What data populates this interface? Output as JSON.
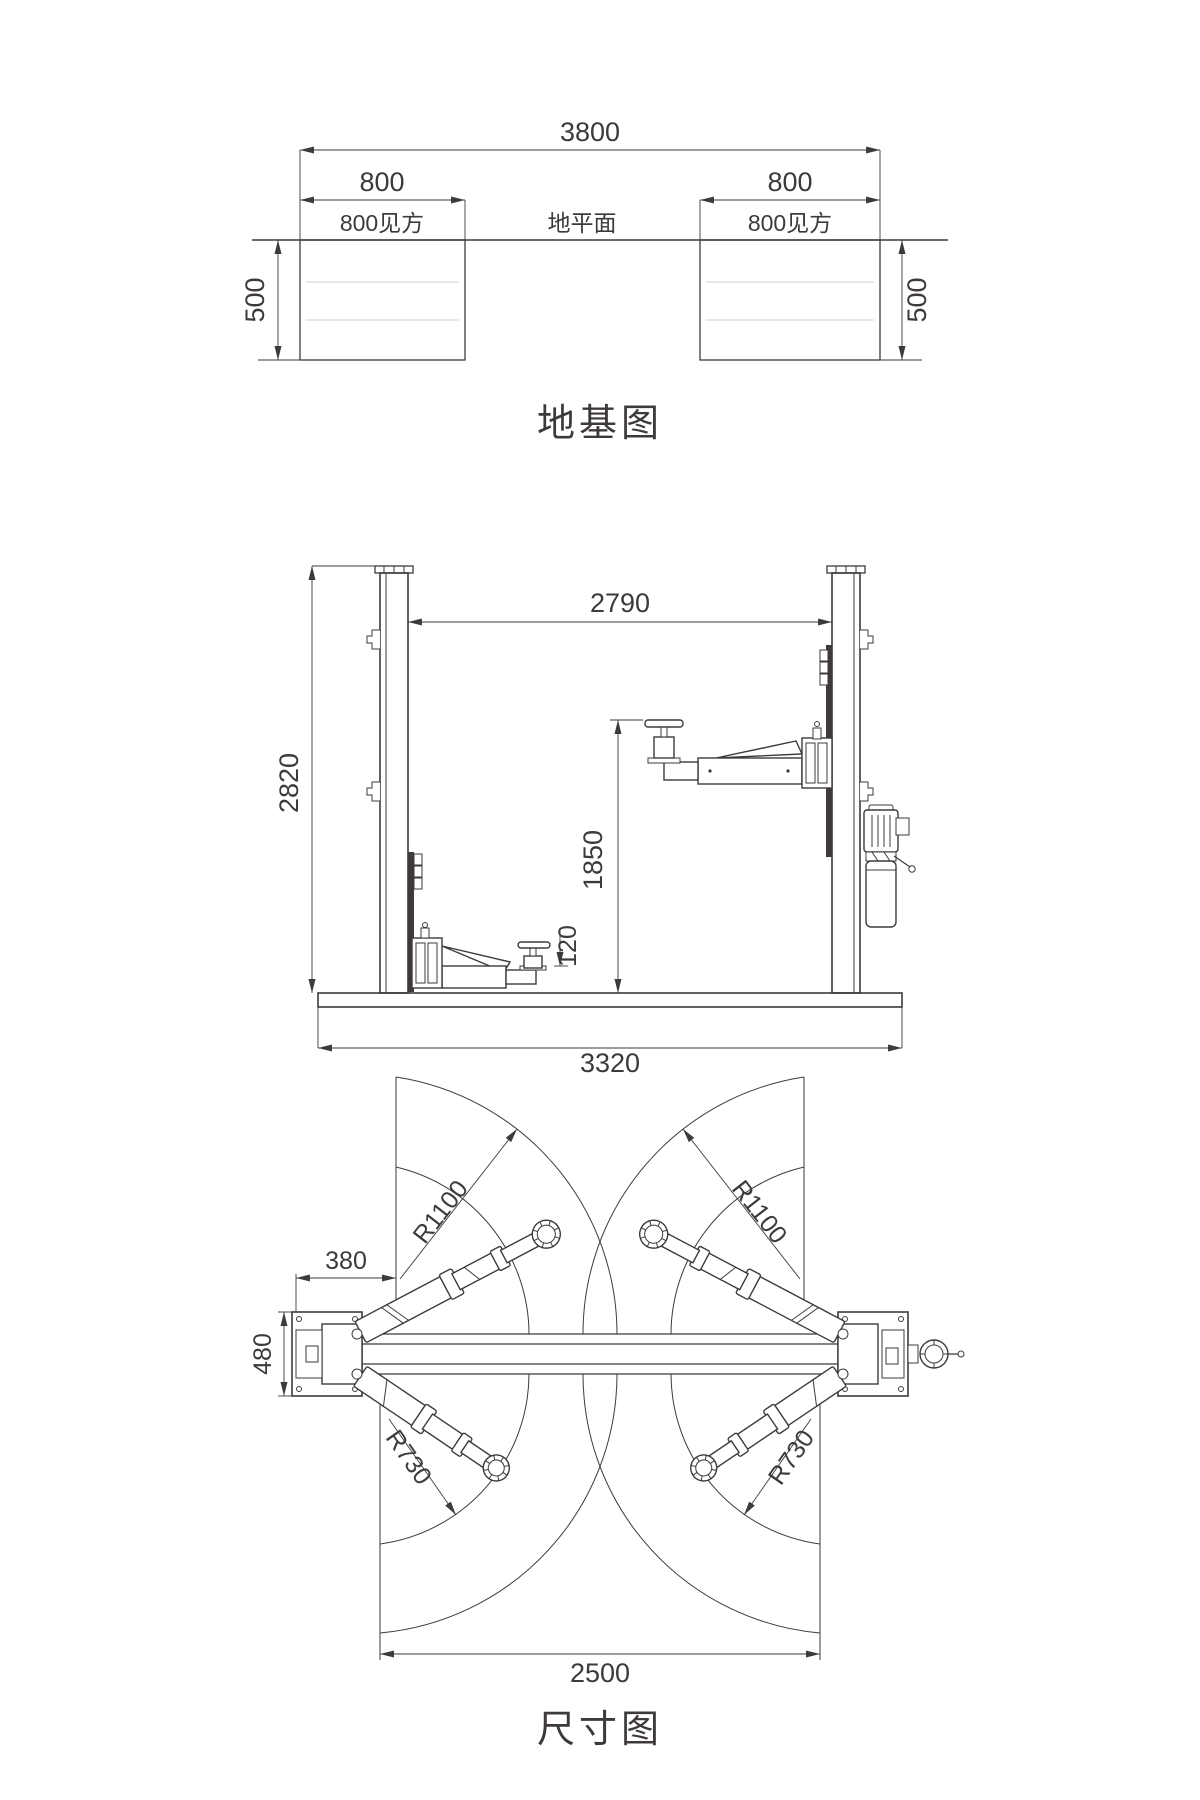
{
  "page": {
    "background": "#ffffff",
    "line_color": "#3e3a39"
  },
  "foundation": {
    "title": "地基图",
    "overall_width": "3800",
    "pad_width": [
      "800",
      "800"
    ],
    "pad_square_label": [
      "800见方",
      "800见方"
    ],
    "ground_label": "地平面",
    "pad_depth": [
      "500",
      "500"
    ]
  },
  "front_view": {
    "post_height": "2820",
    "inner_clear_width": "2790",
    "max_lift_height": "1850",
    "min_pad_height": "120",
    "overall_base_width": "3320"
  },
  "plan_view": {
    "title": "尺寸图",
    "base_plate_width": "380",
    "base_plate_depth": "480",
    "long_arm_radius": [
      "R1100",
      "R1100"
    ],
    "short_arm_radius": [
      "R730",
      "R730"
    ],
    "inner_span": "2500"
  }
}
